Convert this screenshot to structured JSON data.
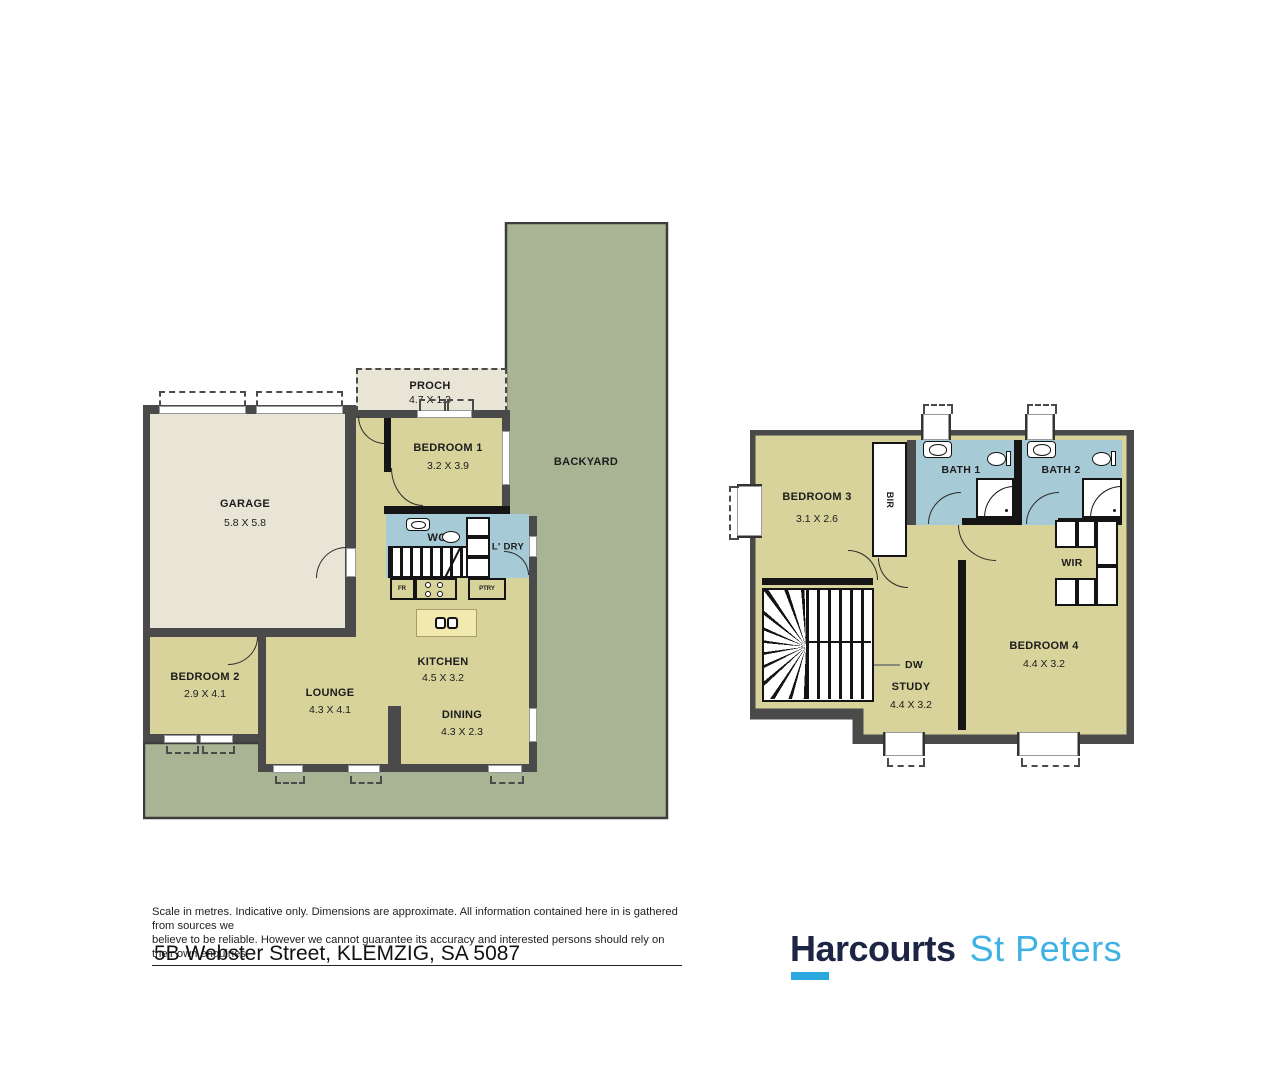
{
  "footer": {
    "disclaimer_line1": "Scale in metres. Indicative only. Dimensions are approximate. All information contained here in is gathered from sources we",
    "disclaimer_line2": "believe to be reliable. However we cannot guarantee its accuracy and interested persons should rely on their own enquiries",
    "address": "5B Webster Street, KLEMZIG, SA 5087"
  },
  "brand": {
    "name": "Harcourts",
    "office": "St Peters"
  },
  "ground_floor": {
    "backyard": {
      "label": "BACKYARD"
    },
    "porch": {
      "label": "PROCH",
      "dims": "4.7 X 1.3"
    },
    "garage": {
      "label": "GARAGE",
      "dims": "5.8 X 5.8"
    },
    "bedroom1": {
      "label": "BEDROOM 1",
      "dims": "3.2 X 3.9"
    },
    "bedroom2": {
      "label": "BEDROOM 2",
      "dims": "2.9 X 4.1"
    },
    "lounge": {
      "label": "LOUNGE",
      "dims": "4.3 X 4.1"
    },
    "kitchen": {
      "label": "KITCHEN",
      "dims": "4.5 X 3.2"
    },
    "dining": {
      "label": "DINING",
      "dims": "4.3 X 2.3"
    },
    "wc": {
      "label": "WC"
    },
    "laundry": {
      "label": "L' DRY"
    },
    "fridge": {
      "label": "FR"
    },
    "pantry": {
      "label": "PTRY"
    }
  },
  "upper_floor": {
    "bedroom3": {
      "label": "BEDROOM 3",
      "dims": "3.1 X 2.6"
    },
    "bir": {
      "label": "BIR"
    },
    "bath1": {
      "label": "BATH 1"
    },
    "bath2": {
      "label": "BATH 2"
    },
    "wir": {
      "label": "WIR"
    },
    "bedroom4": {
      "label": "BEDROOM 4",
      "dims": "4.4 X 3.2"
    },
    "study": {
      "label": "STUDY",
      "dims": "4.4 X 3.2"
    },
    "dw": {
      "label": "DW"
    }
  },
  "colors": {
    "room_fill": "#d7d39b",
    "yard_fill": "#a9b495",
    "garage_fill": "#e8e4d6",
    "wet_area_fill": "#a7cbd6",
    "island_fill": "#f2e9ae",
    "wall": "#4a4a4a",
    "brand_navy": "#1d2545",
    "brand_blue": "#3fb1e3"
  }
}
